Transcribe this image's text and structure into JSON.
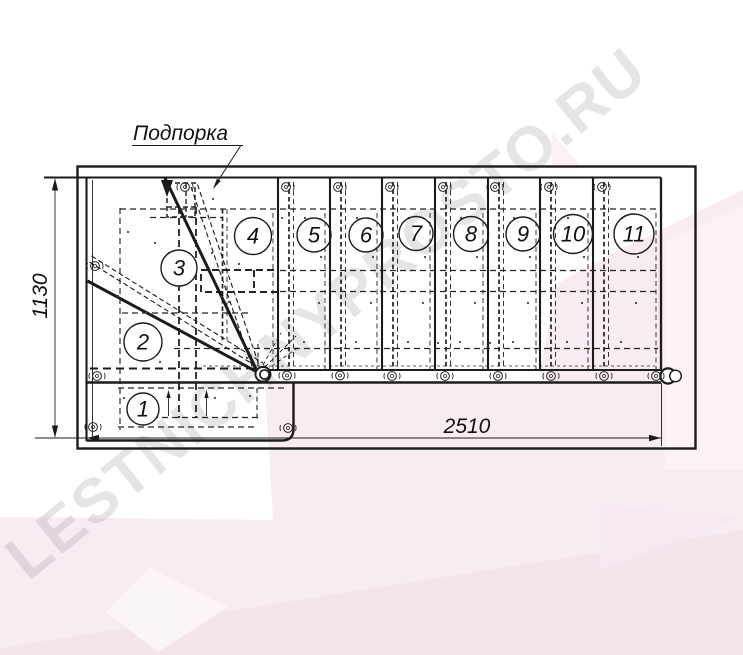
{
  "watermark": {
    "text": "LESTNICHNYPROSTO.RU"
  },
  "drawing": {
    "type": "staircase-plan-top-view",
    "callout_label": "Подпорка",
    "dimension_height": "1130",
    "dimension_width": "2510",
    "steps": [
      {
        "label": "1"
      },
      {
        "label": "2"
      },
      {
        "label": "3"
      },
      {
        "label": "4"
      },
      {
        "label": "5"
      },
      {
        "label": "6"
      },
      {
        "label": "7"
      },
      {
        "label": "8"
      },
      {
        "label": "9"
      },
      {
        "label": "10"
      },
      {
        "label": "11"
      }
    ],
    "step_count": 11
  },
  "icons": {
    "fastener": "screw-icon",
    "stringer_end": "round-cap-icon"
  },
  "colors": {
    "line": "#1b1b1b",
    "pink_base": "#f8ecf3",
    "pink_deep": "#f4e5ed",
    "pink_light": "#fbf2f7",
    "watermark_gray": "#e9e7e9"
  }
}
